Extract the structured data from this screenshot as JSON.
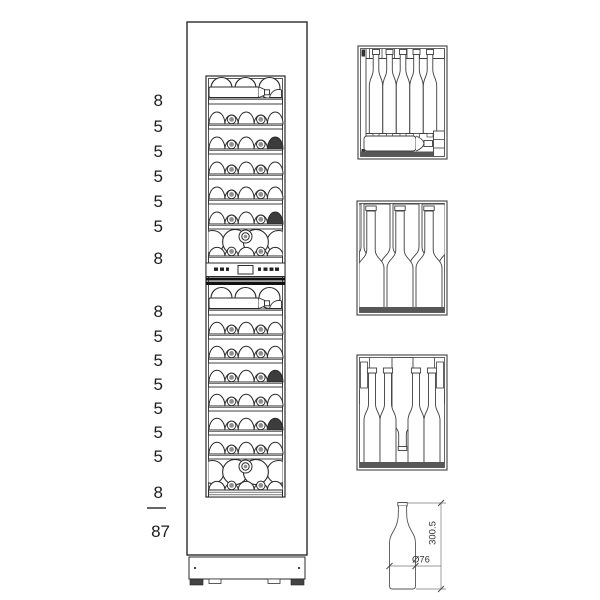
{
  "cabinet": {
    "zones": [
      {
        "name": "upper-zone",
        "rows": [
          {
            "count": "8",
            "style": "display"
          },
          {
            "count": "5",
            "style": "rack"
          },
          {
            "count": "5",
            "style": "rack"
          },
          {
            "count": "5",
            "style": "rack"
          },
          {
            "count": "5",
            "style": "rack"
          },
          {
            "count": "5",
            "style": "rack"
          },
          {
            "count": "8",
            "style": "stacked"
          }
        ]
      },
      {
        "name": "lower-zone",
        "rows": [
          {
            "count": "8",
            "style": "display"
          },
          {
            "count": "5",
            "style": "rack"
          },
          {
            "count": "5",
            "style": "rack"
          },
          {
            "count": "5",
            "style": "rack"
          },
          {
            "count": "5",
            "style": "rack"
          },
          {
            "count": "5",
            "style": "rack"
          },
          {
            "count": "5",
            "style": "rack"
          },
          {
            "count": "8",
            "style": "stacked"
          }
        ]
      }
    ],
    "total": "87"
  },
  "bottle_dimensions": {
    "height": "300.5",
    "diameter": "Ø76"
  },
  "colors": {
    "ink": "#2b2b2b",
    "detail_line": "#3f3f3f",
    "band": "#575757",
    "dark_fill": "#3c3c3c",
    "punt": "#8f8f8f"
  }
}
